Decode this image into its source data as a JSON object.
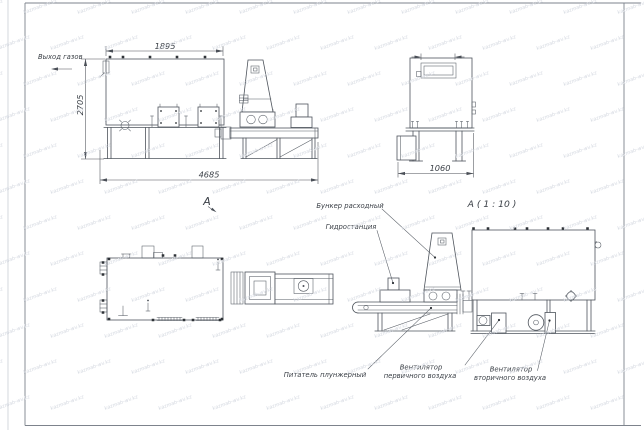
{
  "drawing": {
    "labels": {
      "gas_outlet": "Выход газов",
      "view_arrow": "А",
      "view_detail": "А ( 1 : 10 )",
      "bunker": "Бункер расходный",
      "hydraulic_station": "Гидростанция",
      "feeder": "Питатель плунжерный",
      "fan_primary": [
        "Вентилятор",
        "первичного воздуха"
      ],
      "fan_secondary": [
        "Вентилятор",
        "вторичного воздуха"
      ]
    },
    "dimensions": {
      "side_top_width": "1895",
      "side_height": "2705",
      "side_total_length": "4685",
      "end_width": "1060"
    },
    "watermark": {
      "text": "kazmab-wv.kz"
    }
  },
  "colors": {
    "line": "#4e545c",
    "text": "#3b4047",
    "watermark": "#d4d8e0",
    "background": "#ffffff"
  }
}
